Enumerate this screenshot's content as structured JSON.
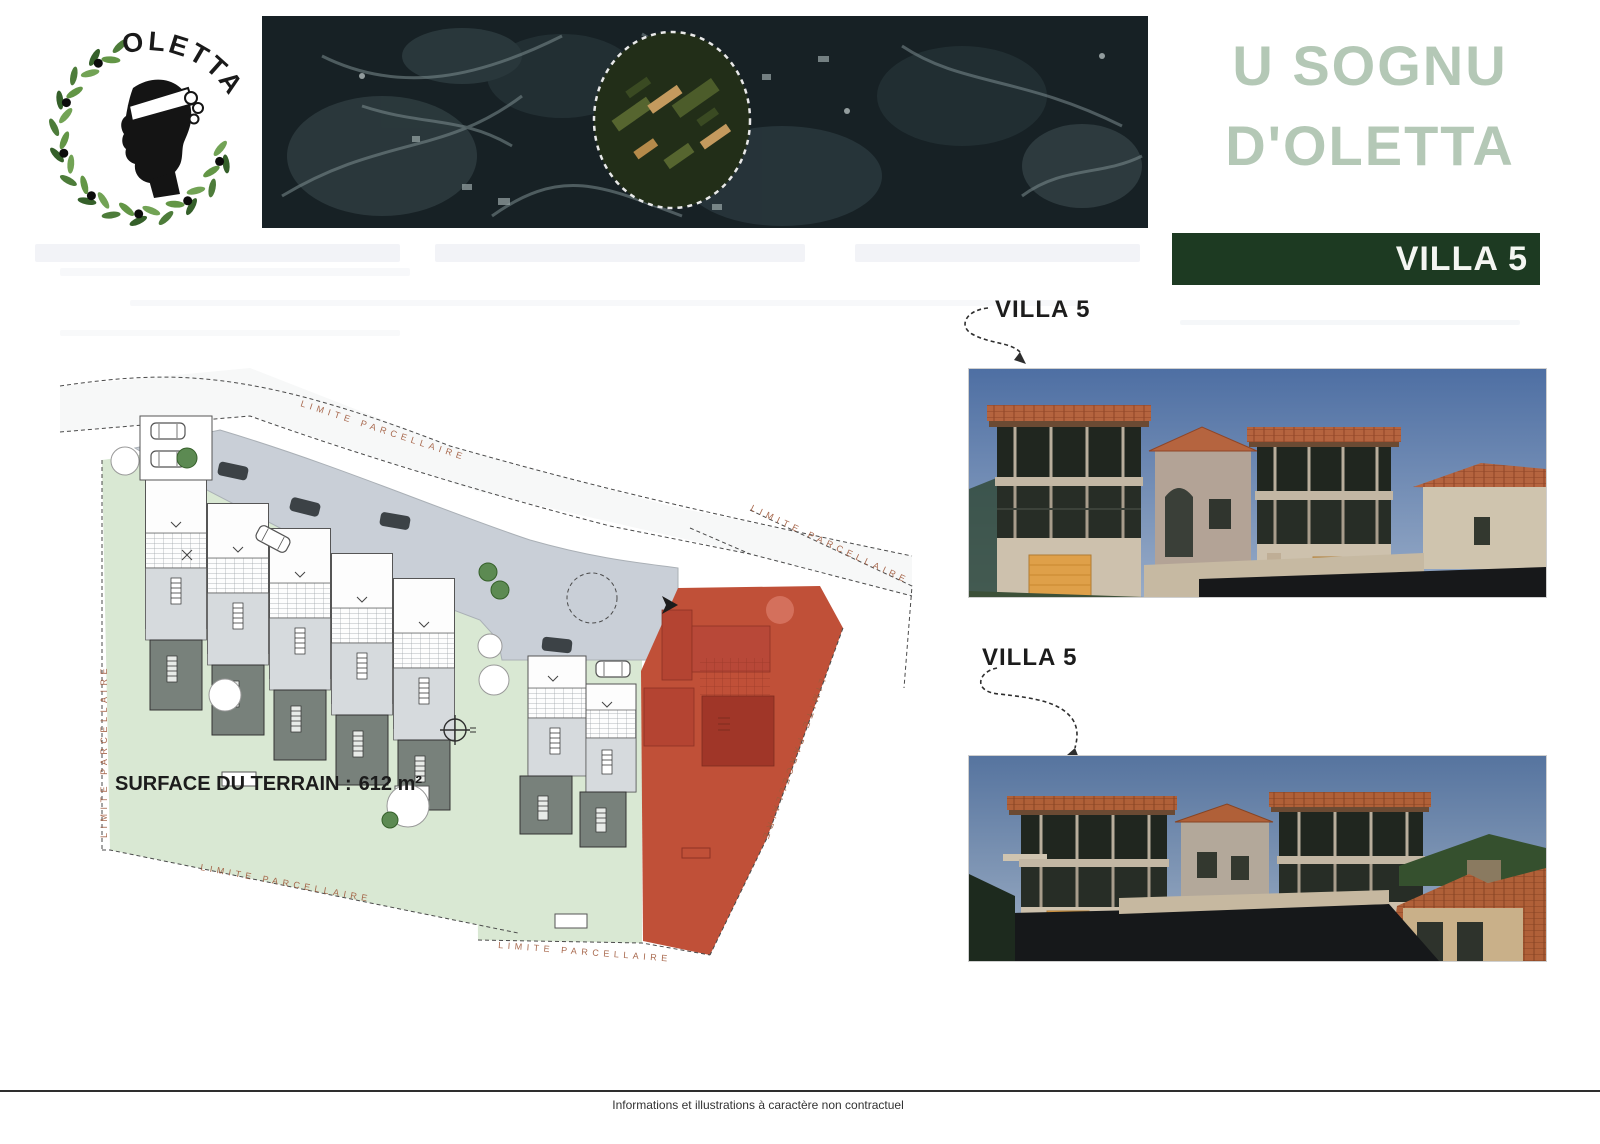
{
  "header": {
    "logo_text": "OLETTA",
    "title_line1": "U SOGNU",
    "title_line2": "D'OLETTA",
    "banner_label": "VILLA 5",
    "title_color": "#b4c8b6",
    "banner_color": "#1d3a22"
  },
  "site_plan": {
    "surface_label": "SURFACE DU TERRAIN :",
    "surface_value": "612 m²",
    "boundary_label": "LIMITE PARCELLAIRE",
    "highlight_color": "#c05038",
    "highlight_footprint_color": "#a83c2c",
    "garden_color": "#d9e8d3",
    "road_color": "#c9cfd7"
  },
  "renderings": [
    {
      "label": "VILLA 5"
    },
    {
      "label": "VILLA 5"
    }
  ],
  "footer": {
    "disclaimer": "Informations et illustrations à caractère non contractuel"
  }
}
